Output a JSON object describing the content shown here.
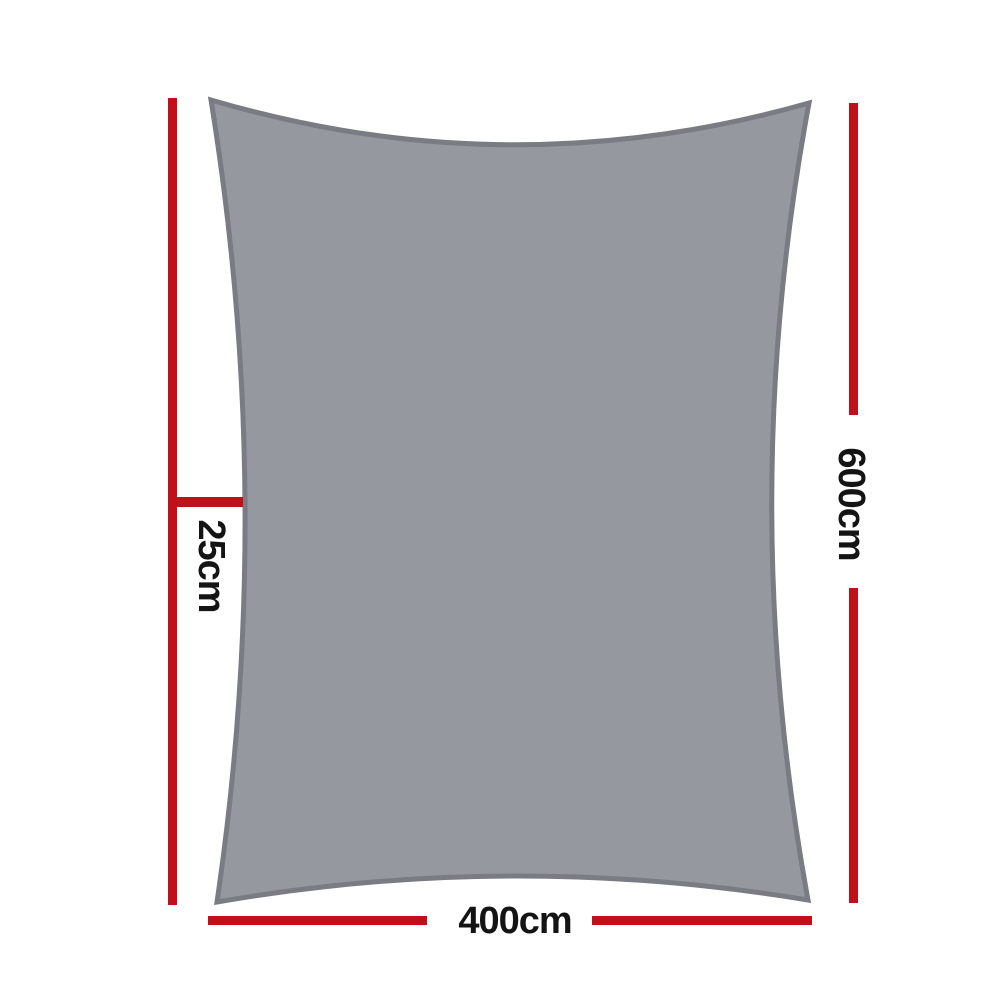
{
  "colors": {
    "background": "#ffffff",
    "sail-fill": "#96989f",
    "sail-border": "#7a7c83",
    "dimension-line": "#c0111b",
    "label-text": "#141414"
  },
  "diagram": {
    "description": "Grey rectangle shade sail shown with red dimension lines",
    "labels": {
      "bottom_width": "400cm",
      "side_height": "600cm",
      "edge_offset": "25cm"
    }
  }
}
